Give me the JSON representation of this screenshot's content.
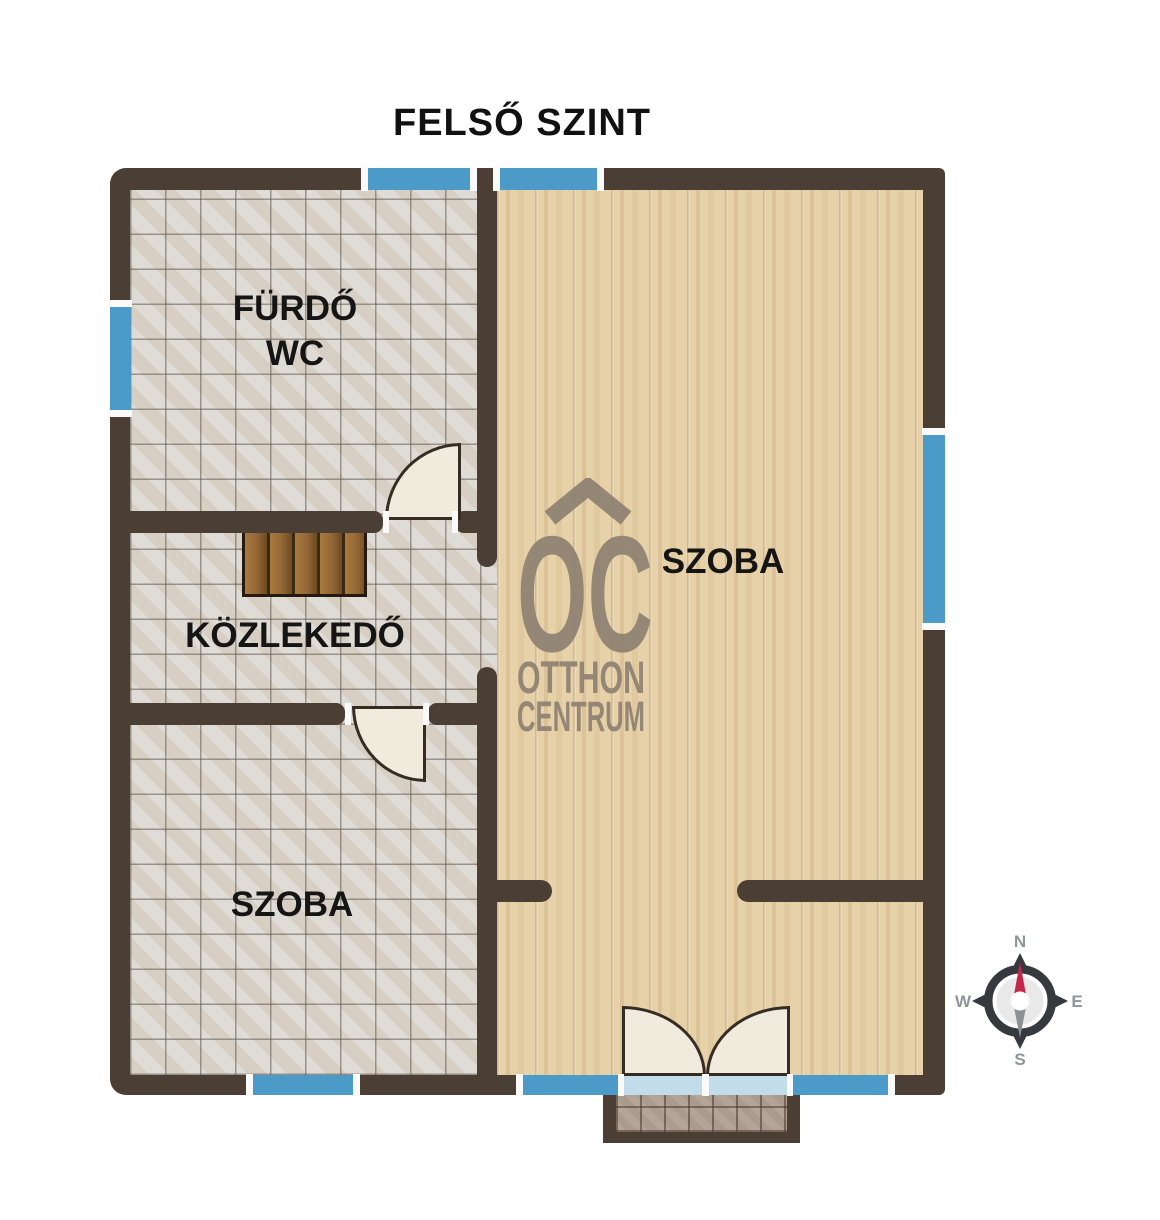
{
  "title": "FELSŐ SZINT",
  "rooms": {
    "bathroom_line1": "FÜRDŐ",
    "bathroom_line2": "WC",
    "corridor": "KÖZLEKEDŐ",
    "room_left": "SZOBA",
    "room_right": "SZOBA"
  },
  "watermark": {
    "monogram": "OC",
    "line1": "OTTHON",
    "line2": "CENTRUM"
  },
  "compass": {
    "n": "N",
    "e": "E",
    "s": "S",
    "w": "W"
  },
  "colors": {
    "wall": "#4b3e34",
    "window": "#4b9ac7",
    "tile_floor": "#dbd7d1",
    "wood_floor": "#e7d1a8",
    "door_leaf": "#f1ebdd",
    "stairs_wood": "#946636",
    "balcony_tile": "#ab9a8d",
    "door_glass": "#c2dde9",
    "compass_needle_north": "#c32749",
    "compass_needle_south": "#8e9194",
    "logo_gray": "#8d8172"
  }
}
